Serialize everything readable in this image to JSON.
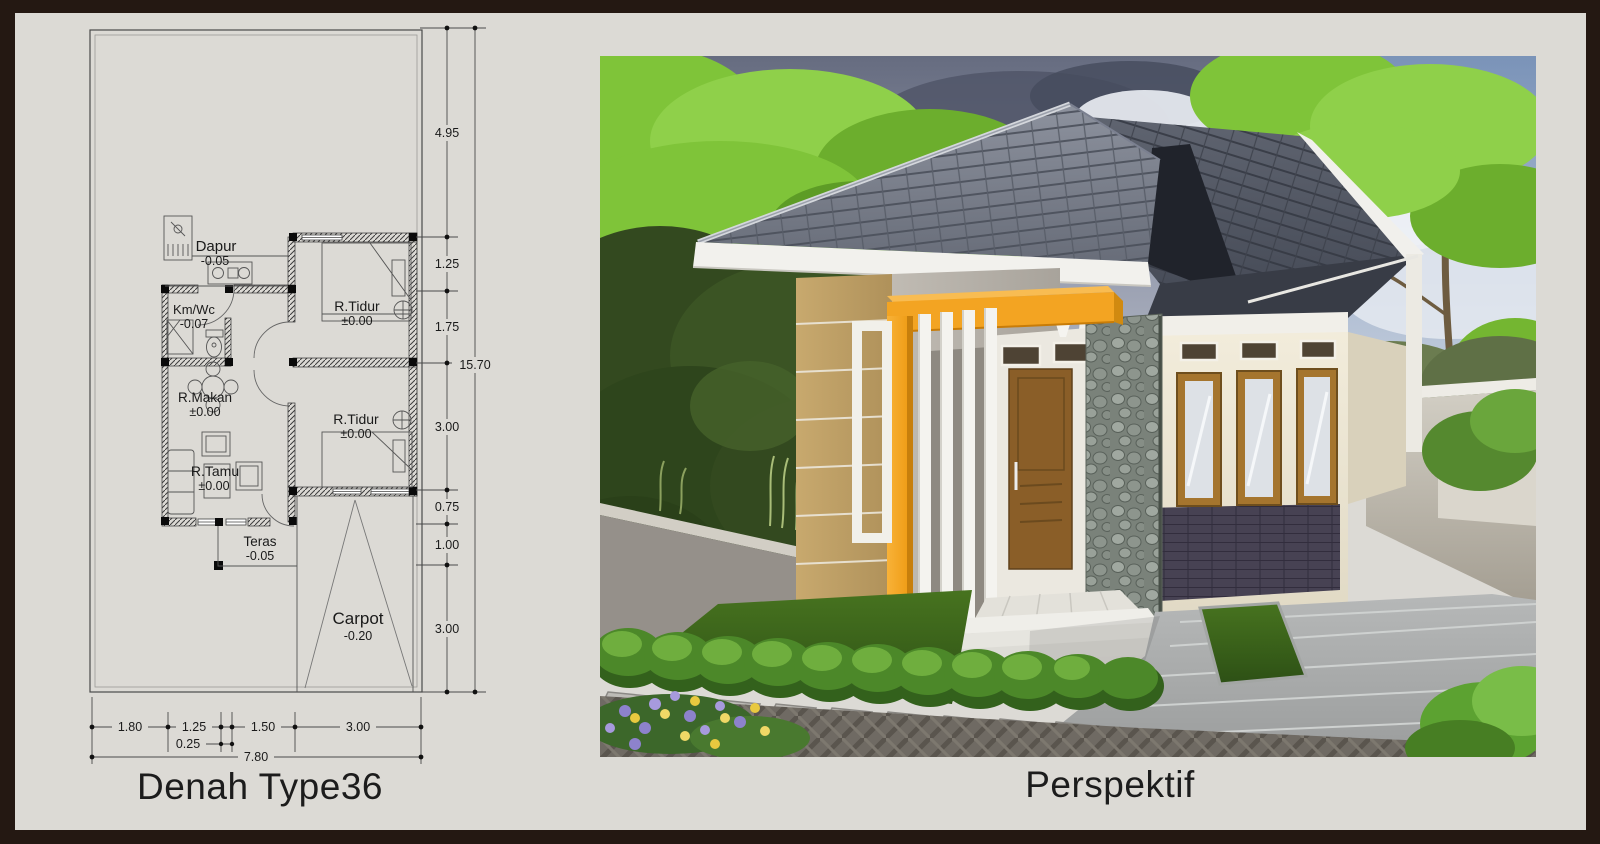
{
  "window": {
    "frame_color": "#241812",
    "background": "#dcdad5"
  },
  "plan": {
    "caption": "Denah Type36",
    "rooms": [
      {
        "name": "Dapur",
        "level": "-0.05"
      },
      {
        "name": "Km/Wc",
        "level": "-0.07"
      },
      {
        "name": "R.Tidur",
        "level": "±0.00"
      },
      {
        "name": "R.Makan",
        "level": "±0.00"
      },
      {
        "name": "R.Tidur",
        "level": "±0.00"
      },
      {
        "name": "R.Tamu",
        "level": "±0.00"
      },
      {
        "name": "Teras",
        "level": "-0.05"
      },
      {
        "name": "Carpot",
        "level": "-0.20"
      }
    ],
    "dims_vertical": [
      "4.95",
      "1.25",
      "1.75",
      "3.00",
      "0.75",
      "1.00",
      "3.00"
    ],
    "dim_vertical_total": "15.70",
    "dims_horizontal": [
      "1.80",
      "1.25",
      "1.50",
      "3.00"
    ],
    "dim_horizontal_sub": "0.25",
    "dim_horizontal_total": "7.80"
  },
  "perspective": {
    "caption": "Perspektif"
  },
  "colors": {
    "accent_orange": "#f3a422",
    "roof_gray": "#81869261",
    "wall_tan": "#bf9f63",
    "wall_cream": "#efe9d6",
    "door_brown": "#8a5e28",
    "grass_green": "#3d6322"
  }
}
